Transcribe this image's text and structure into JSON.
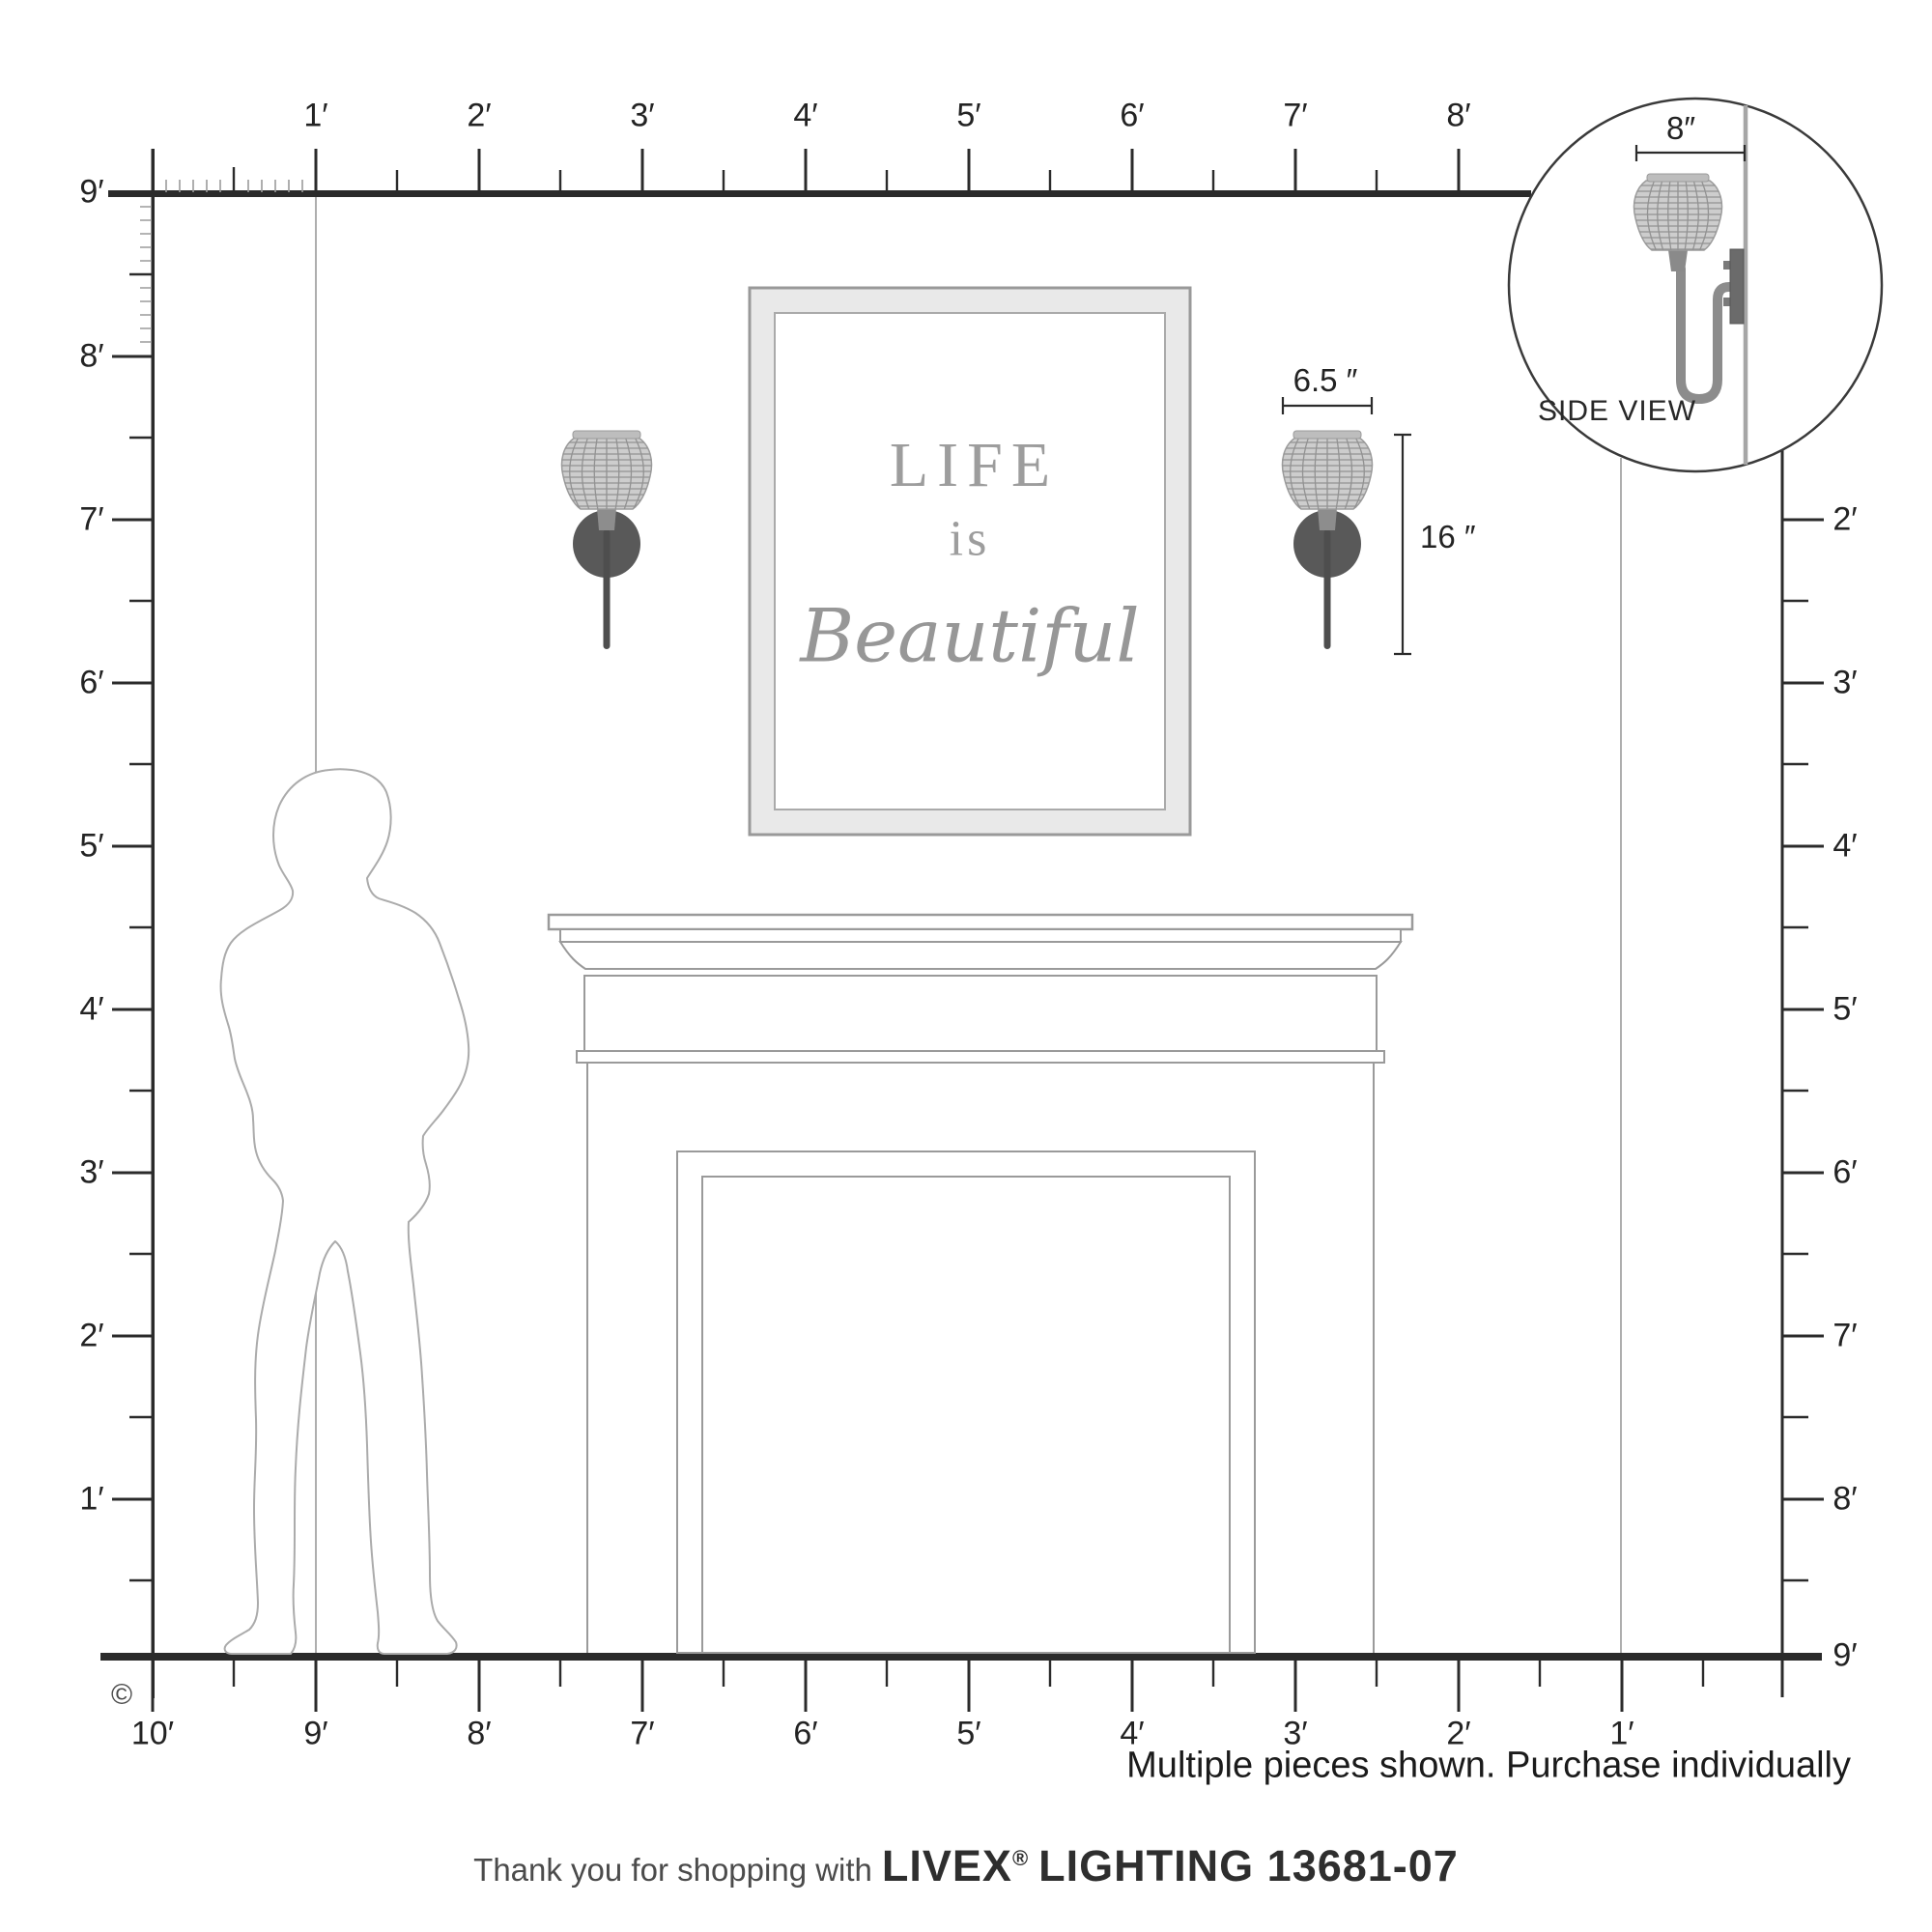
{
  "top_ruler": {
    "labels": [
      "1′",
      "2′",
      "3′",
      "4′",
      "5′",
      "6′",
      "7′",
      "8′"
    ]
  },
  "left_ruler": {
    "labels": [
      "9′",
      "8′",
      "7′",
      "6′",
      "5′",
      "4′",
      "3′",
      "2′",
      "1′"
    ]
  },
  "right_ruler": {
    "labels": [
      "2′",
      "3′",
      "4′",
      "5′",
      "6′",
      "7′",
      "8′",
      "9′"
    ]
  },
  "bottom_ruler": {
    "labels": [
      "10′",
      "9′",
      "8′",
      "7′",
      "6′",
      "5′",
      "4′",
      "3′",
      "2′",
      "1′"
    ]
  },
  "artwork": {
    "line1": "LIFE",
    "line2": "is",
    "line3": "Beautiful"
  },
  "dimensions": {
    "width_label": "6.5 ″",
    "height_label": "16 ″",
    "depth_label": "8″"
  },
  "inset": {
    "caption": "SIDE VIEW"
  },
  "notes": {
    "purchase_note": "Multiple pieces shown. Purchase individually",
    "copyright_mark": "©"
  },
  "footer": {
    "prefix": "Thank you for shopping with",
    "brand": "LIVEX",
    "registered": "®",
    "suffix": "LIGHTING 13681-07"
  },
  "colors": {
    "ruler_dark": "#2b2b2b",
    "tick_light": "#9b9b9b",
    "corner_line": "#aeaeae",
    "outline_gray": "#9a9a9a",
    "frame_fill": "#e9e9e9",
    "shade_fill": "#cdcdcd",
    "plate_dark": "#595959",
    "text_gray": "#9d9d9d"
  }
}
